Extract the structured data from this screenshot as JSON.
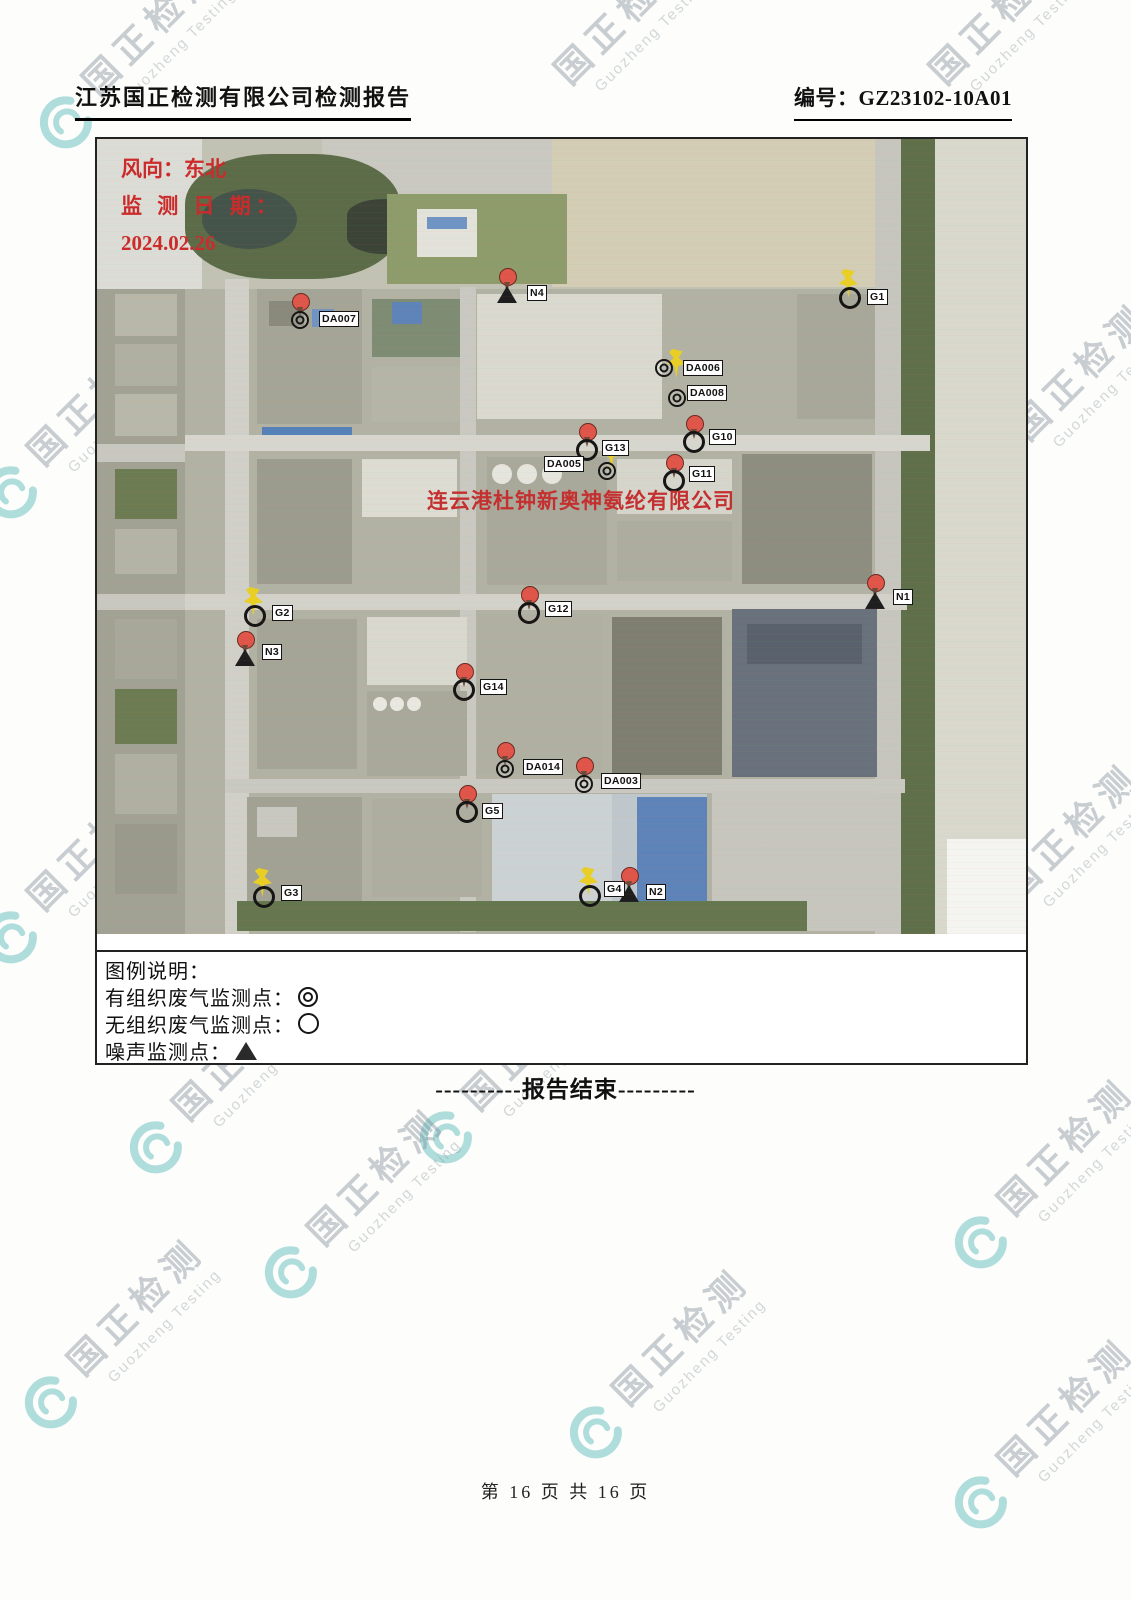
{
  "header": {
    "title": "江苏国正检测有限公司检测报告",
    "report_no": "编号：GZ23102-10A01"
  },
  "map": {
    "annotations": {
      "wind": "风向：东北",
      "date_label": "监 测 日 期：",
      "date": "2024.02.26",
      "company": "连云港杜钟新奥神氨纶有限公司"
    },
    "markers": [
      {
        "id": "DA007",
        "label": "DA007",
        "pin": "red",
        "symbol": "double",
        "x": 203,
        "y": 181,
        "lx": 222,
        "ly": 172
      },
      {
        "id": "N4",
        "label": "N4",
        "pin": "red",
        "symbol": "triangle",
        "x": 410,
        "y": 156,
        "lx": 430,
        "ly": 146
      },
      {
        "id": "G1",
        "label": "G1",
        "pin": "yellow",
        "symbol": "circle",
        "x": 753,
        "y": 159,
        "lx": 770,
        "ly": 150
      },
      {
        "id": "DA006",
        "label": "DA006",
        "pin": "yellow",
        "symbol": "double",
        "x": 567,
        "y": 229,
        "lx": 586,
        "ly": 221,
        "pdx": 14,
        "pdy": 10
      },
      {
        "id": "DA008",
        "label": "DA008",
        "pin": null,
        "symbol": "double",
        "x": 580,
        "y": 259,
        "lx": 590,
        "ly": 246
      },
      {
        "id": "G10",
        "label": "G10",
        "pin": "red",
        "symbol": "circle",
        "x": 597,
        "y": 303,
        "lx": 612,
        "ly": 290
      },
      {
        "id": "G13",
        "label": "G13",
        "pin": "red",
        "symbol": "circle",
        "x": 490,
        "y": 311,
        "lx": 505,
        "ly": 301
      },
      {
        "id": "DA005",
        "label": "DA005",
        "pin": "yellow",
        "symbol": "double",
        "x": 510,
        "y": 332,
        "lx": 447,
        "ly": 317,
        "pdx": 6,
        "pdy": -2
      },
      {
        "id": "G11",
        "label": "G11",
        "pin": "red",
        "symbol": "circle",
        "x": 577,
        "y": 342,
        "lx": 592,
        "ly": 327
      },
      {
        "id": "G2",
        "label": "G2",
        "pin": "yellow",
        "symbol": "circle",
        "x": 158,
        "y": 477,
        "lx": 175,
        "ly": 466
      },
      {
        "id": "N3",
        "label": "N3",
        "pin": "red",
        "symbol": "triangle",
        "x": 148,
        "y": 519,
        "lx": 165,
        "ly": 505
      },
      {
        "id": "G12",
        "label": "G12",
        "pin": "red",
        "symbol": "circle",
        "x": 432,
        "y": 474,
        "lx": 448,
        "ly": 462
      },
      {
        "id": "N1",
        "label": "N1",
        "pin": "red",
        "symbol": "triangle",
        "x": 778,
        "y": 462,
        "lx": 796,
        "ly": 450
      },
      {
        "id": "G14",
        "label": "G14",
        "pin": "red",
        "symbol": "circle",
        "x": 367,
        "y": 551,
        "lx": 383,
        "ly": 540
      },
      {
        "id": "DA014",
        "label": "DA014",
        "pin": "red",
        "symbol": "double",
        "x": 408,
        "y": 630,
        "lx": 426,
        "ly": 620
      },
      {
        "id": "DA003",
        "label": "DA003",
        "pin": "red",
        "symbol": "double",
        "x": 487,
        "y": 645,
        "lx": 504,
        "ly": 634
      },
      {
        "id": "G5",
        "label": "G5",
        "pin": "red",
        "symbol": "circle",
        "x": 370,
        "y": 673,
        "lx": 385,
        "ly": 664
      },
      {
        "id": "G3",
        "label": "G3",
        "pin": "yellow",
        "symbol": "circle",
        "x": 167,
        "y": 758,
        "lx": 184,
        "ly": 746
      },
      {
        "id": "G4",
        "label": "G4",
        "pin": "yellow",
        "symbol": "circle",
        "x": 493,
        "y": 757,
        "lx": 507,
        "ly": 742
      },
      {
        "id": "N2",
        "label": "N2",
        "pin": "red",
        "symbol": "triangle",
        "x": 532,
        "y": 755,
        "lx": 549,
        "ly": 745
      }
    ]
  },
  "legend": {
    "title": "图例说明：",
    "items": [
      {
        "label": "有组织废气监测点：",
        "symbol": "double"
      },
      {
        "label": "无组织废气监测点：",
        "symbol": "circle"
      },
      {
        "label": "噪声监测点：",
        "symbol": "triangle"
      }
    ]
  },
  "end_text": "----------报告结束---------",
  "footer": {
    "page_text": "第 16 页 共 16 页"
  },
  "watermark": {
    "cn": "国正检测",
    "en": "Guozheng Testing"
  },
  "colors": {
    "annotation_red": "#cb2b2b",
    "company_red": "#c43030",
    "pin_red": "#e05549",
    "pin_yellow": "#e9cf25",
    "watermark_teal": "#3aacb0"
  }
}
